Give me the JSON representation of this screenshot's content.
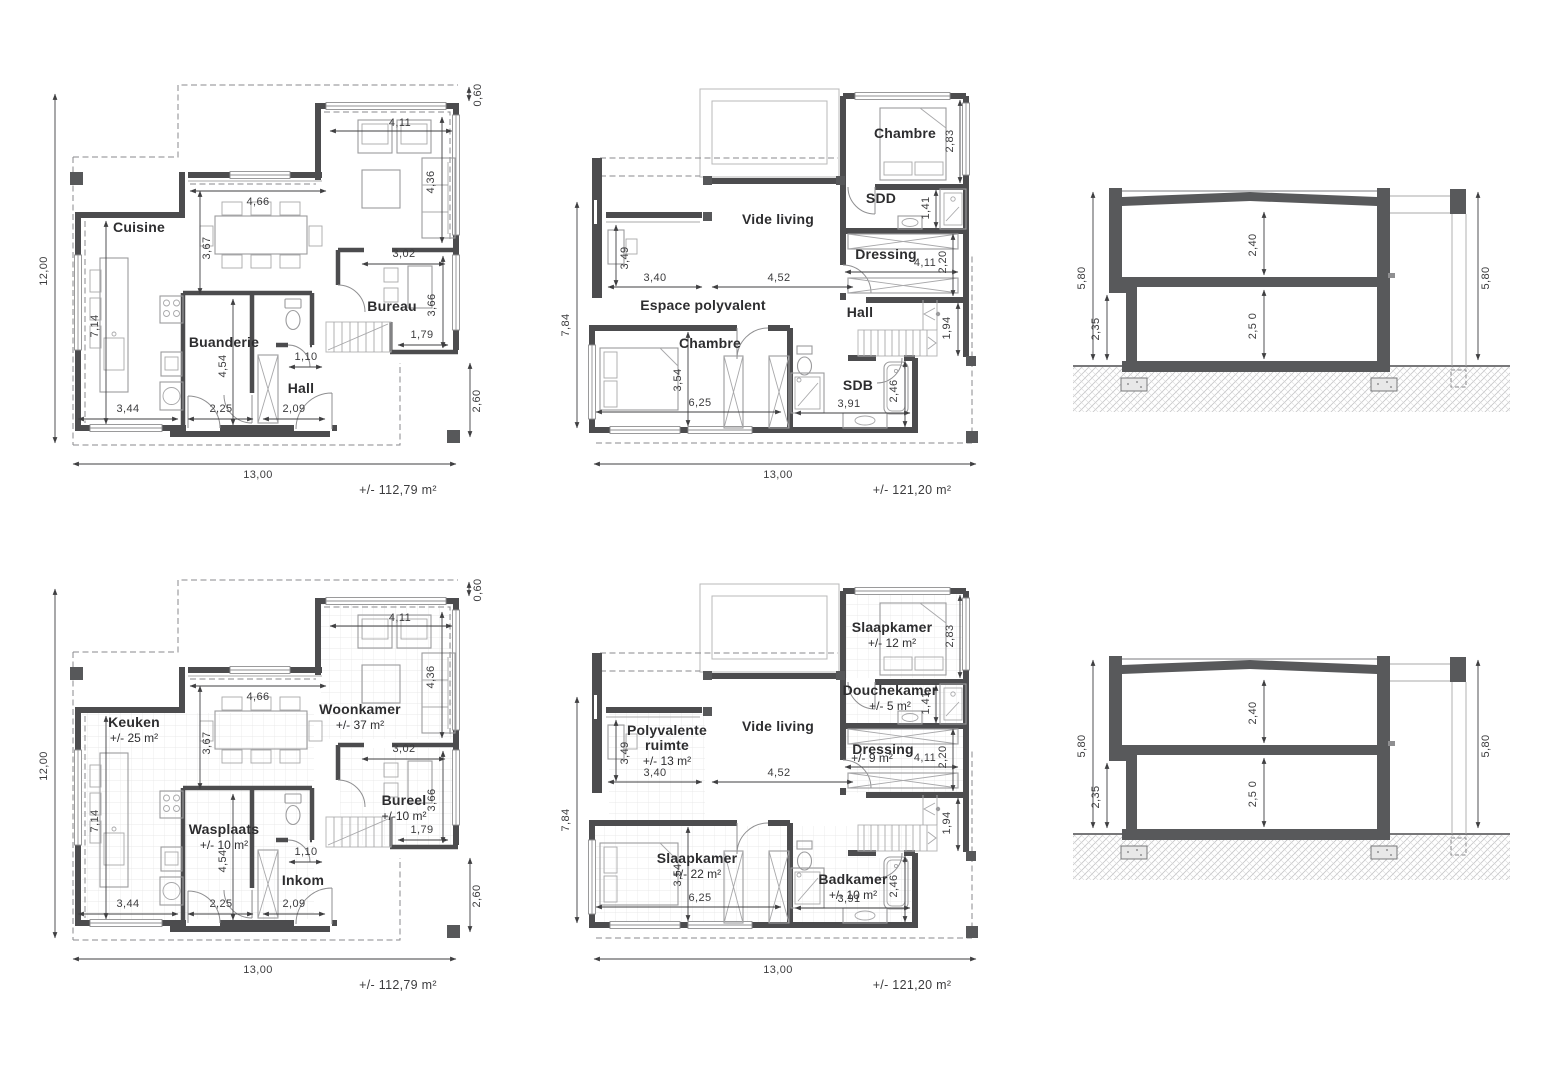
{
  "sheet": {
    "ground_floor": {
      "area_label": "+/- 112,79 m²",
      "dims": {
        "total_h": "12,00",
        "overhang": "0,60",
        "living_w": "4,11",
        "living_h": "4,36",
        "dining_w": "4,66",
        "dining_h": "3,67",
        "bureau_w": "3,02",
        "bureau_h": "3,66",
        "kitchen_h": "7,14",
        "laundry_h": "4,54",
        "hall_w": "1,10",
        "stair_w": "1,79",
        "b1": "3,44",
        "b2": "2,25",
        "b3": "2,09",
        "terrace_h": "2,60",
        "total_w": "13,00"
      },
      "fr": {
        "cuisine": "Cuisine",
        "buanderie": "Buanderie",
        "hall": "Hall",
        "bureau": "Bureau"
      },
      "nl": {
        "keuken": "Keuken",
        "keuken_area": "+/- 25 m²",
        "woonkamer": "Woonkamer",
        "woonkamer_area": "+/- 37 m²",
        "wasplaats": "Wasplaats",
        "wasplaats_area": "+/- 10 m²",
        "inkom": "Inkom",
        "bureel": "Bureel",
        "bureel_area": "+/-10 m²"
      }
    },
    "upper_floor": {
      "area_label": "+/- 121,20 m²",
      "dims": {
        "total_h": "7,84",
        "bed1_h": "2,83",
        "sdd_h": "1,41",
        "dress_h": "2,20",
        "dress_w": "4,11",
        "poly_h": "3,49",
        "poly_w": "3,40",
        "vide_w": "4,52",
        "stair_h": "1,94",
        "bed2_h": "3,54",
        "bed2_w": "6,25",
        "bath_h": "2,46",
        "bath_w": "3,91",
        "total_w": "13,00"
      },
      "fr": {
        "chambre1": "Chambre",
        "sdd": "SDD",
        "dressing": "Dressing",
        "vide": "Vide living",
        "espace": "Espace polyvalent",
        "hall": "Hall",
        "chambre2": "Chambre",
        "sdb": "SDB"
      },
      "nl": {
        "slaapkamer1": "Slaapkamer",
        "slaapkamer1_area": "+/- 12 m²",
        "douchekamer": "Douchekamer",
        "douchekamer_area": "+/- 5 m²",
        "dressing": "Dressing",
        "dressing_area": "+/- 9 m²",
        "vide": "Vide living",
        "poly1": "Polyvalente",
        "poly2": "ruimte",
        "poly_area": "+/- 13 m²",
        "slaapkamer2": "Slaapkamer",
        "slaapkamer2_area": "+/- 22 m²",
        "badkamer": "Badkamer",
        "badkamer_area": "+/- 10 m²"
      }
    },
    "section": {
      "dims": {
        "total_l": "5,80",
        "ground_l": "2,35",
        "upper_h": "2,40",
        "lower_h": "2,5 0",
        "total_r": "5,80"
      }
    }
  }
}
